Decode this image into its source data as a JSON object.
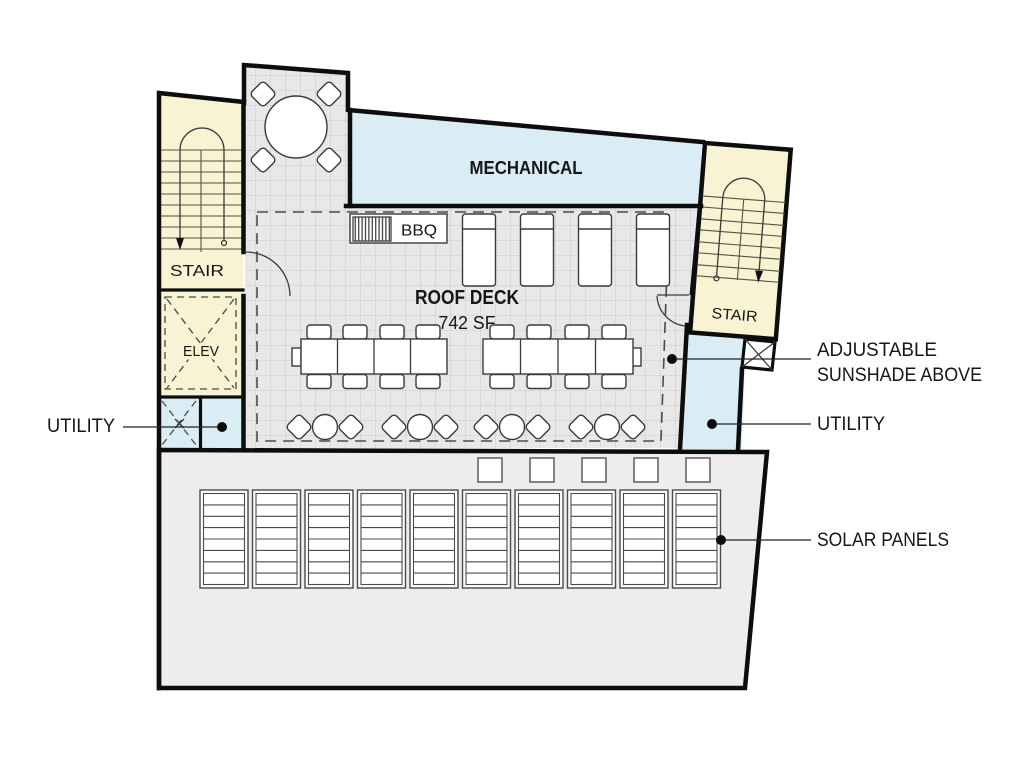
{
  "plan": {
    "rooms": {
      "mechanical": "MECHANICAL",
      "roof_deck_title": "ROOF DECK",
      "roof_deck_area": "742 SF",
      "stair_left": "STAIR",
      "stair_right": "STAIR",
      "elevator": "ELEV",
      "bbq": "BBQ"
    },
    "callouts": {
      "utility_left": "UTILITY",
      "utility_right": "UTILITY",
      "sunshade_line1": "ADJUSTABLE",
      "sunshade_line2": "SUNSHADE ABOVE",
      "solar_panels": "SOLAR PANELS"
    },
    "colors": {
      "stair_fill": "#f7f3d3",
      "utility_fill": "#daedf4",
      "deck_fill": "#e8e8e8",
      "deck_grid": "#cbcbcb",
      "solar_fill": "#ededed",
      "wall": "#0d0d0d"
    }
  }
}
